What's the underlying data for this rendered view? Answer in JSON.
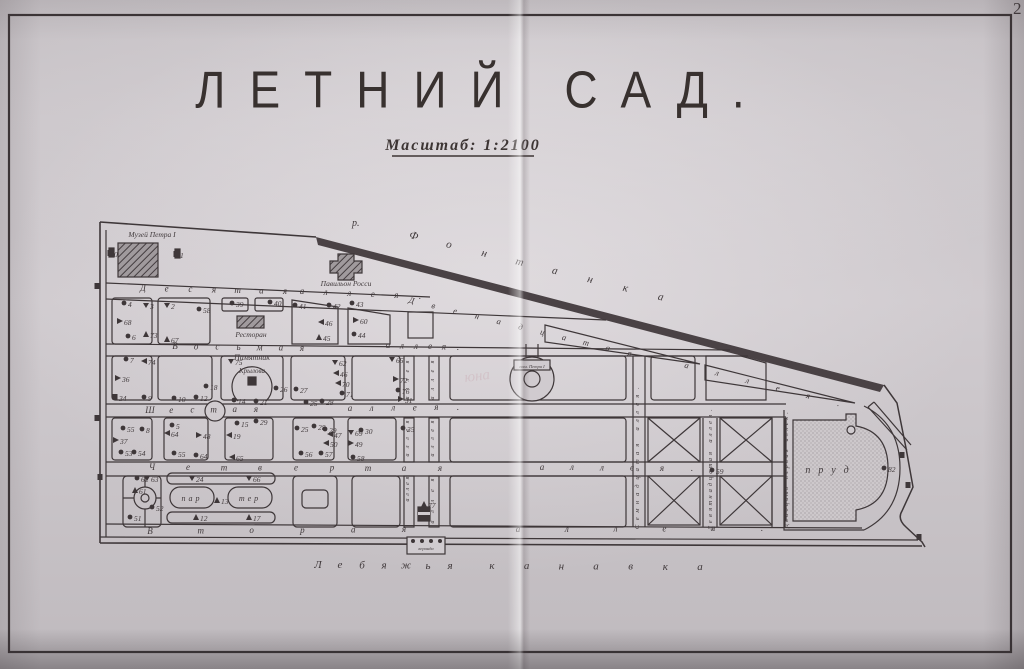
{
  "page": {
    "corner_number": "2",
    "title": "ЛЕТНИЙ САД.",
    "scale_note": "Масштаб: 1:2100",
    "ghost_mark": "юна"
  },
  "colors": {
    "ink": "#3e3739",
    "paper": "#d0cbcf",
    "pond_fill": "#cdc8cb"
  },
  "landmarks": {
    "museum": "Музей Петра I",
    "pavilion": "Павильон Росси",
    "restaurant": "Ресторан",
    "monument_line1": "Памятник",
    "monument_line2": "Крылова",
    "fountain_plate": "пам. Петра I",
    "pond": "пруд",
    "parterre_part1": "пар",
    "parterre_part2": "тер",
    "veranda": "веранда",
    "river_abbrev": "р."
  },
  "map": {
    "alley_labels": [
      {
        "text": "Десятая",
        "x1": 143,
        "y1": 291,
        "x2": 285,
        "y2": 294,
        "size": 9,
        "rot": "none"
      },
      {
        "text": "аллея.",
        "x1": 302,
        "y1": 294,
        "x2": 420,
        "y2": 299,
        "size": 9,
        "rot": "none"
      },
      {
        "text": "Восьмая",
        "x1": 175,
        "y1": 349,
        "x2": 302,
        "y2": 351,
        "size": 9,
        "rot": "none"
      },
      {
        "text": "аллея.",
        "x1": 388,
        "y1": 348,
        "x2": 458,
        "y2": 350,
        "size": 9,
        "rot": "none"
      },
      {
        "text": "Шестая",
        "x1": 150,
        "y1": 413,
        "x2": 256,
        "y2": 412,
        "size": 9,
        "rot": "none"
      },
      {
        "text": "аллея.",
        "x1": 350,
        "y1": 411,
        "x2": 458,
        "y2": 410,
        "size": 9,
        "rot": "none"
      },
      {
        "text": "Четвертая",
        "x1": 152,
        "y1": 470,
        "x2": 440,
        "y2": 471,
        "size": 9,
        "rot": "none"
      },
      {
        "text": "аллея.",
        "x1": 542,
        "y1": 470,
        "x2": 692,
        "y2": 471,
        "size": 9,
        "rot": "none"
      },
      {
        "text": "Вторая",
        "x1": 150,
        "y1": 534,
        "x2": 404,
        "y2": 532,
        "size": 9,
        "rot": "none"
      },
      {
        "text": "аллея.",
        "x1": 518,
        "y1": 532,
        "x2": 762,
        "y2": 531,
        "size": 9,
        "rot": "none"
      },
      {
        "text": "Двенадцатая",
        "x1": 411,
        "y1": 303,
        "x2": 629,
        "y2": 356,
        "size": 8.5,
        "rot": "line"
      },
      {
        "text": "аллея.",
        "x1": 686,
        "y1": 368,
        "x2": 838,
        "y2": 406,
        "size": 8.5,
        "rot": "line"
      },
      {
        "text": "Семнадцатая аллея.",
        "x1": 639,
        "y1": 527,
        "x2": 639,
        "y2": 388,
        "size": 6.5,
        "rot": "vert"
      },
      {
        "text": "Девятнадцатая аллея.",
        "x1": 712,
        "y1": 528,
        "x2": 712,
        "y2": 410,
        "size": 6.5,
        "rot": "vert"
      },
      {
        "text": "Двадцать первая аллея.",
        "x1": 788,
        "y1": 526,
        "x2": 788,
        "y2": 413,
        "size": 6,
        "rot": "vert"
      },
      {
        "text": "аллея",
        "x1": 409,
        "y1": 398,
        "x2": 409,
        "y2": 362,
        "size": 6,
        "rot": "vert"
      },
      {
        "text": "аллея",
        "x1": 434,
        "y1": 398,
        "x2": 434,
        "y2": 362,
        "size": 6,
        "rot": "vert"
      },
      {
        "text": "аллея",
        "x1": 409,
        "y1": 455,
        "x2": 409,
        "y2": 422,
        "size": 6,
        "rot": "vert"
      },
      {
        "text": "аллея",
        "x1": 434,
        "y1": 455,
        "x2": 434,
        "y2": 422,
        "size": 6,
        "rot": "vert"
      },
      {
        "text": "аллея",
        "x1": 409,
        "y1": 500,
        "x2": 409,
        "y2": 478,
        "size": 6,
        "rot": "vert"
      },
      {
        "text": "аллея",
        "x1": 434,
        "y1": 522,
        "x2": 434,
        "y2": 480,
        "size": 6,
        "rot": "vert"
      }
    ],
    "river_labels": [
      {
        "text": "Фонтанка",
        "x1": 413,
        "y1": 239,
        "x2": 660,
        "y2": 300,
        "size": 11,
        "rot": "line"
      },
      {
        "text": "Лебяжья",
        "x1": 318,
        "y1": 568,
        "x2": 450,
        "y2": 569,
        "size": 11,
        "rot": "none"
      },
      {
        "text": "канавка",
        "x1": 492,
        "y1": 569,
        "x2": 700,
        "y2": 570,
        "size": 11,
        "rot": "none"
      }
    ],
    "points": [
      {
        "x": 124,
        "y": 303,
        "n": "4",
        "m": "d"
      },
      {
        "x": 146,
        "y": 305,
        "n": "3",
        "m": "v"
      },
      {
        "x": 120,
        "y": 321,
        "n": "68",
        "m": "r"
      },
      {
        "x": 128,
        "y": 336,
        "n": "6",
        "m": "d"
      },
      {
        "x": 146,
        "y": 334,
        "n": "73",
        "m": "a"
      },
      {
        "x": 167,
        "y": 305,
        "n": "2",
        "m": "v"
      },
      {
        "x": 199,
        "y": 309,
        "n": "58",
        "m": "d"
      },
      {
        "x": 167,
        "y": 339,
        "n": "67",
        "m": "a"
      },
      {
        "x": 232,
        "y": 303,
        "n": "39",
        "m": "d"
      },
      {
        "x": 270,
        "y": 302,
        "n": "40",
        "m": "d"
      },
      {
        "x": 295,
        "y": 305,
        "n": "41",
        "m": "d"
      },
      {
        "x": 329,
        "y": 305,
        "n": "42",
        "m": "d"
      },
      {
        "x": 352,
        "y": 303,
        "n": "43",
        "m": "d"
      },
      {
        "x": 356,
        "y": 320,
        "n": "60",
        "m": "r"
      },
      {
        "x": 354,
        "y": 334,
        "n": "44",
        "m": "d"
      },
      {
        "x": 321,
        "y": 322,
        "n": "46",
        "m": "l"
      },
      {
        "x": 319,
        "y": 337,
        "n": "45",
        "m": "a"
      },
      {
        "x": 126,
        "y": 359,
        "n": "7",
        "m": "d"
      },
      {
        "x": 144,
        "y": 361,
        "n": "74",
        "m": "l"
      },
      {
        "x": 118,
        "y": 378,
        "n": "36",
        "m": "r"
      },
      {
        "x": 115,
        "y": 397,
        "n": "34",
        "m": "s"
      },
      {
        "x": 144,
        "y": 397,
        "n": "9",
        "m": "d"
      },
      {
        "x": 231,
        "y": 361,
        "n": "75",
        "m": "v"
      },
      {
        "x": 174,
        "y": 398,
        "n": "10",
        "m": "d"
      },
      {
        "x": 196,
        "y": 397,
        "n": "12",
        "m": "d"
      },
      {
        "x": 206,
        "y": 386,
        "n": "18",
        "m": "d"
      },
      {
        "x": 234,
        "y": 400,
        "n": "14",
        "m": "d"
      },
      {
        "x": 256,
        "y": 401,
        "n": "21",
        "m": "d"
      },
      {
        "x": 276,
        "y": 388,
        "n": "26",
        "m": "d"
      },
      {
        "x": 296,
        "y": 389,
        "n": "27",
        "m": "d"
      },
      {
        "x": 306,
        "y": 402,
        "n": "25",
        "m": "d"
      },
      {
        "x": 322,
        "y": 401,
        "n": "28",
        "m": "d"
      },
      {
        "x": 335,
        "y": 362,
        "n": "62",
        "m": "v"
      },
      {
        "x": 336,
        "y": 373,
        "n": "46",
        "m": "l"
      },
      {
        "x": 338,
        "y": 383,
        "n": "70",
        "m": "l"
      },
      {
        "x": 342,
        "y": 393,
        "n": "71",
        "m": "d"
      },
      {
        "x": 392,
        "y": 359,
        "n": "65",
        "m": "v"
      },
      {
        "x": 396,
        "y": 379,
        "n": "72",
        "m": "r"
      },
      {
        "x": 398,
        "y": 390,
        "n": "76",
        "m": "d"
      },
      {
        "x": 401,
        "y": 399,
        "n": "31",
        "m": "r"
      },
      {
        "x": 403,
        "y": 428,
        "n": "35",
        "m": "d"
      },
      {
        "x": 123,
        "y": 428,
        "n": "55",
        "m": "d"
      },
      {
        "x": 142,
        "y": 429,
        "n": "8",
        "m": "d"
      },
      {
        "x": 116,
        "y": 440,
        "n": "37",
        "m": "r"
      },
      {
        "x": 121,
        "y": 452,
        "n": "53",
        "m": "d"
      },
      {
        "x": 134,
        "y": 452,
        "n": "54",
        "m": "d"
      },
      {
        "x": 172,
        "y": 425,
        "n": "5",
        "m": "d"
      },
      {
        "x": 167,
        "y": 433,
        "n": "64",
        "m": "l"
      },
      {
        "x": 199,
        "y": 435,
        "n": "48",
        "m": "r"
      },
      {
        "x": 174,
        "y": 453,
        "n": "55",
        "m": "d"
      },
      {
        "x": 196,
        "y": 455,
        "n": "64",
        "m": "d"
      },
      {
        "x": 237,
        "y": 423,
        "n": "15",
        "m": "d"
      },
      {
        "x": 256,
        "y": 421,
        "n": "29",
        "m": "d"
      },
      {
        "x": 229,
        "y": 435,
        "n": "19",
        "m": "l"
      },
      {
        "x": 232,
        "y": 457,
        "n": "65",
        "m": "l"
      },
      {
        "x": 297,
        "y": 428,
        "n": "25",
        "m": "d"
      },
      {
        "x": 314,
        "y": 426,
        "n": "28",
        "m": "d"
      },
      {
        "x": 325,
        "y": 429,
        "n": "29",
        "m": "d"
      },
      {
        "x": 330,
        "y": 434,
        "n": "47",
        "m": "l"
      },
      {
        "x": 326,
        "y": 443,
        "n": "50",
        "m": "l"
      },
      {
        "x": 301,
        "y": 453,
        "n": "56",
        "m": "d"
      },
      {
        "x": 321,
        "y": 453,
        "n": "57",
        "m": "d"
      },
      {
        "x": 351,
        "y": 432,
        "n": "69",
        "m": "v"
      },
      {
        "x": 361,
        "y": 430,
        "n": "30",
        "m": "d"
      },
      {
        "x": 351,
        "y": 443,
        "n": "49",
        "m": "r"
      },
      {
        "x": 353,
        "y": 457,
        "n": "58",
        "m": "d"
      },
      {
        "x": 137,
        "y": 478,
        "n": "62",
        "m": "d"
      },
      {
        "x": 147,
        "y": 478,
        "n": "63",
        "m": "v"
      },
      {
        "x": 135,
        "y": 490,
        "n": "61",
        "m": "a"
      },
      {
        "x": 152,
        "y": 507,
        "n": "52",
        "m": "d"
      },
      {
        "x": 130,
        "y": 517,
        "n": "51",
        "m": "d"
      },
      {
        "x": 192,
        "y": 478,
        "n": "24",
        "m": "v"
      },
      {
        "x": 249,
        "y": 478,
        "n": "66",
        "m": "v"
      },
      {
        "x": 217,
        "y": 500,
        "n": "13",
        "m": "a"
      },
      {
        "x": 196,
        "y": 517,
        "n": "12",
        "m": "a"
      },
      {
        "x": 249,
        "y": 517,
        "n": "17",
        "m": "a"
      },
      {
        "x": 424,
        "y": 504,
        "n": "77",
        "m": "a"
      },
      {
        "x": 712,
        "y": 470,
        "n": "59",
        "m": "d"
      },
      {
        "x": 884,
        "y": 468,
        "n": "82",
        "m": "d"
      },
      {
        "x": 110,
        "y": 253,
        "n": "0",
        "m": "s"
      },
      {
        "x": 176,
        "y": 254,
        "n": "1",
        "m": "s"
      },
      {
        "x": 97,
        "y": 286,
        "n": "",
        "m": "s"
      },
      {
        "x": 97,
        "y": 418,
        "n": "",
        "m": "s"
      },
      {
        "x": 100,
        "y": 477,
        "n": "",
        "m": "s"
      },
      {
        "x": 902,
        "y": 455,
        "n": "",
        "m": "s"
      },
      {
        "x": 908,
        "y": 485,
        "n": "",
        "m": "s"
      },
      {
        "x": 919,
        "y": 537,
        "n": "",
        "m": "s"
      }
    ]
  }
}
